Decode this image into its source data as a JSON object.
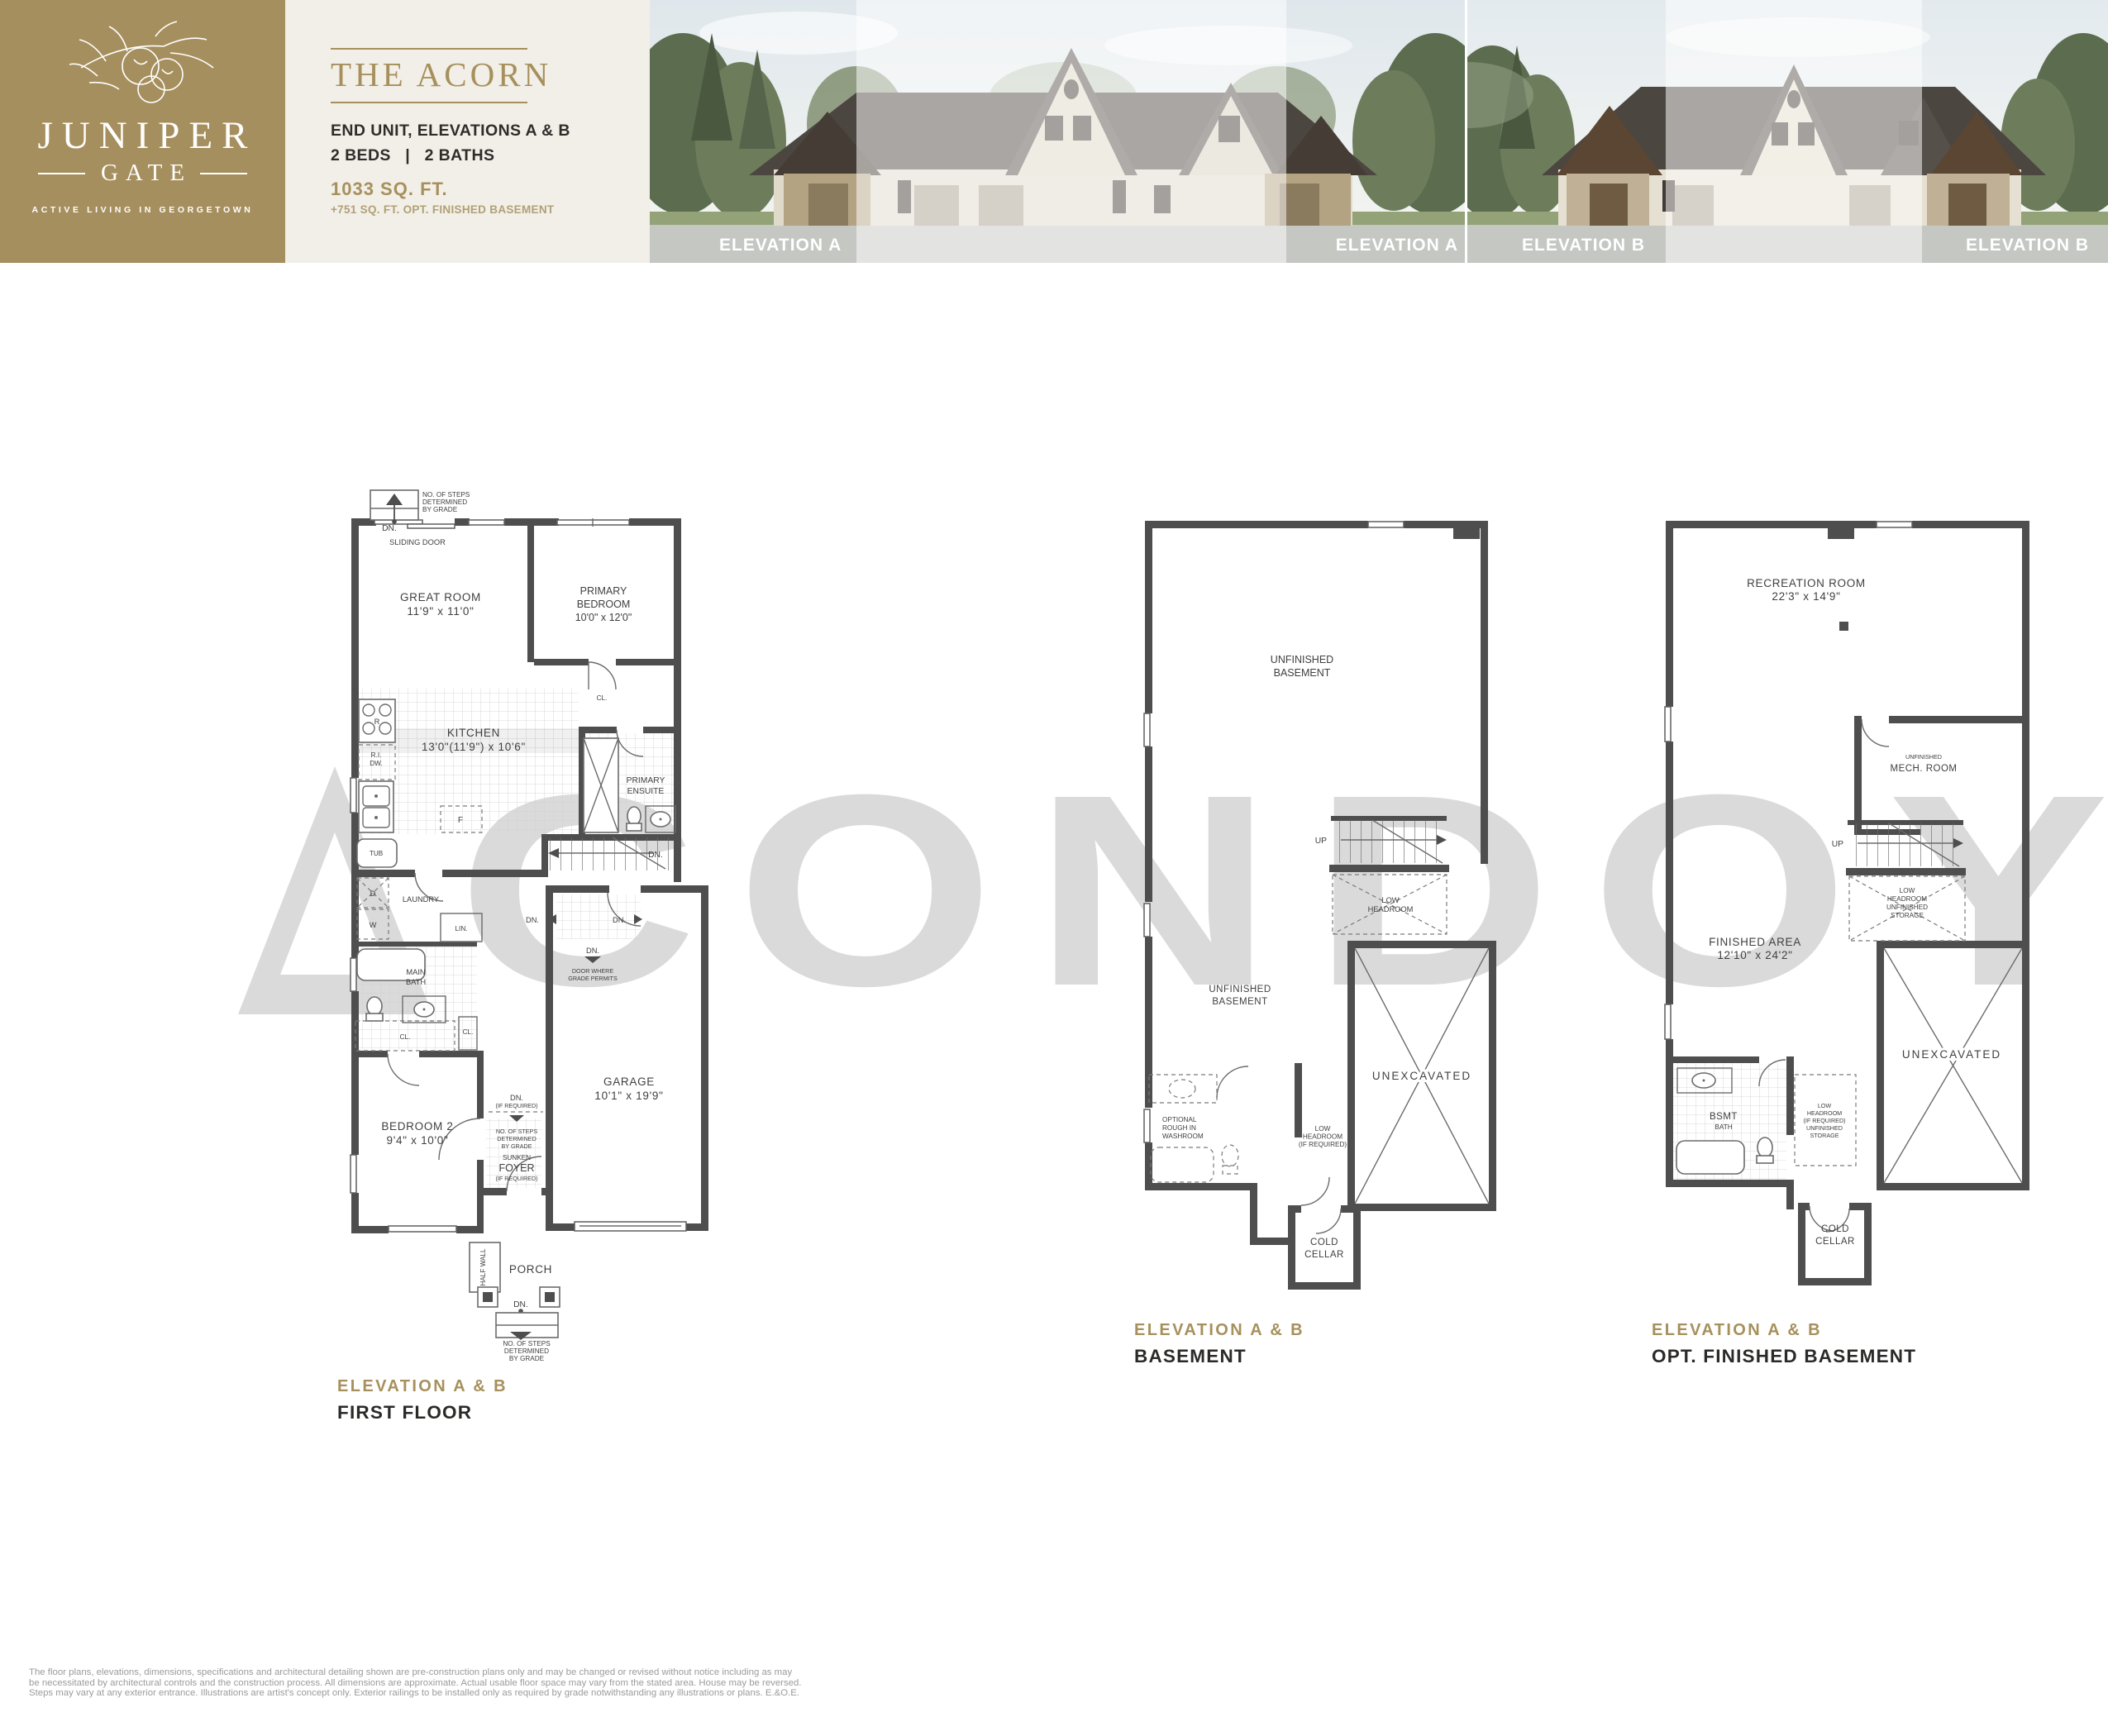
{
  "colors": {
    "brand_gold": "#a6905c",
    "logo_bg": "#a68f5e",
    "cream": "#f2efe8",
    "wall_gray": "#4e4e4e",
    "watermark_gray": "#dadada",
    "dark_text": "#2b2a28"
  },
  "brand": {
    "name_top": "JUNIPER",
    "name_bottom": "GATE",
    "tagline": "ACTIVE LIVING IN GEORGETOWN"
  },
  "header": {
    "plan_name": "THE ACORN",
    "subtitle": "END UNIT, ELEVATIONS A & B",
    "beds_baths": "2 BEDS   |   2 BATHS",
    "sqft": "1033 SQ. FT.",
    "sqft_note": "+751 SQ. FT. OPT. FINISHED BASEMENT"
  },
  "photos": {
    "photo_a": {
      "label_left": "ELEVATION A",
      "label_right": "ELEVATION A"
    },
    "photo_b": {
      "label_left": "ELEVATION B",
      "label_right": "ELEVATION B"
    }
  },
  "watermark": {
    "text": "CONDOY"
  },
  "plans": {
    "first_floor": {
      "caption": {
        "elevation": "ELEVATION A & B",
        "floor": "FIRST FLOOR"
      },
      "labels": {
        "steps_top": "NO. OF STEPS\nDETERMINED\nBY GRADE",
        "dn_top": "DN.",
        "sliding_door": "SLIDING DOOR",
        "great_room": "GREAT ROOM\n11'9\" x 11'0\"",
        "primary_bedroom": "PRIMARY\nBEDROOM\n10'0\" x 12'0\"",
        "kitchen": "KITCHEN\n13'0\"(11'9\") x 10'6\"",
        "range": "R",
        "ri_dw": "R.I.\nDW.",
        "fridge": "F",
        "closet_bedroom": "CL.",
        "primary_ensuite": "PRIMARY\nENSUITE",
        "stairs_dn": "DN.",
        "tub_room": "TUB",
        "dryer": "D",
        "washer": "W",
        "laundry": "LAUNDRY",
        "linen": "LIN.",
        "main_bath": "MAIN\nBATH",
        "closet_hall": "CL.",
        "closet_bedroom2": "CL.",
        "bedroom2": "BEDROOM 2\n9'4\" x 10'0\"",
        "landing_dn_left": "DN.",
        "landing_dn_right": "DN.",
        "side_door_dn": "DN.",
        "door_where_grade": "DOOR WHERE\nGRADE PERMITS",
        "garage": "GARAGE\n10'1\" x 19'9\"",
        "foyer_dn": "DN.",
        "foyer_dn_note": "(IF REQUIRED)",
        "foyer_steps": "NO. OF STEPS\nDETERMINED\nBY GRADE",
        "sunken": "SUNKEN",
        "foyer": "FOYER",
        "foyer_note": "(IF REQUIRED)",
        "half_wall": "HALF WALL",
        "porch": "PORCH",
        "porch_dn": "DN.",
        "steps_bottom": "NO. OF STEPS\nDETERMINED\nBY GRADE"
      }
    },
    "basement": {
      "caption": {
        "elevation": "ELEVATION A & B",
        "floor": "BASEMENT"
      },
      "labels": {
        "unfinished_1": "UNFINISHED\nBASEMENT",
        "up": "UP",
        "low_headroom": "LOW\nHEADROOM",
        "unfinished_2": "UNFINISHED\nBASEMENT",
        "washroom": "OPTIONAL\nROUGH IN\nWASHROOM",
        "low_headroom_req": "LOW\nHEADROOM\n(IF REQUIRED)",
        "unexcavated": "UNEXCAVATED",
        "cold_cellar": "COLD\nCELLAR"
      }
    },
    "opt_finished_basement": {
      "caption": {
        "elevation": "ELEVATION A & B",
        "floor": "OPT. FINISHED BASEMENT"
      },
      "labels": {
        "recreation_room": "RECREATION ROOM\n22'3\" x 14'9\"",
        "mech_room_small": "UNFINISHED",
        "mech_room": "MECH. ROOM",
        "up": "UP",
        "low_headroom_storage": "LOW\nHEADROOM\nUNFINISHED\nSTORAGE",
        "finished_area": "FINISHED AREA\n12'10\" x 24'2\"",
        "bsmt": "BSMT",
        "bath": "BATH",
        "low_headroom_req_storage": "LOW\nHEADROOM\n(IF REQUIRED)\nUNFINISHED\nSTORAGE",
        "unexcavated": "UNEXCAVATED",
        "cold_cellar": "COLD\nCELLAR"
      }
    }
  },
  "footer": {
    "line1": "The floor plans, elevations, dimensions, specifications and architectural detailing shown are pre-construction plans only and may be changed or revised without notice including as may",
    "line2": "be necessitated by architectural controls and the construction process. All dimensions are approximate. Actual usable floor space may vary from the stated area. House may be reversed.",
    "line3": "Steps may vary at any exterior entrance. Illustrations are artist's concept only. Exterior railings to be installed only as required by grade notwithstanding any illustrations or plans. E.&O.E."
  }
}
